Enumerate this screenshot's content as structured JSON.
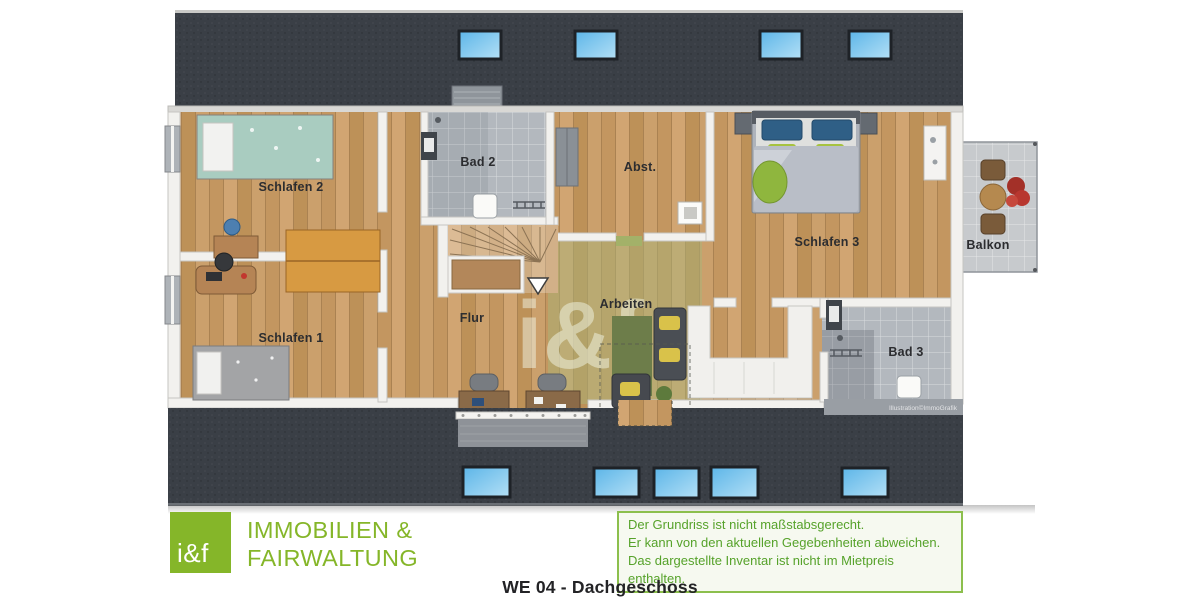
{
  "meta": {
    "title": "WE 04 - Dachgeschoss"
  },
  "branding": {
    "logo_text": "i&f",
    "company_line1": "IMMOBILIEN &",
    "company_line2": "FAIRWALTUNG",
    "brand_green": "#85b629"
  },
  "disclaimer": {
    "line1": "Der Grundriss ist nicht maßstabsgerecht.",
    "line2": "Er kann von den aktuellen Gegebenheiten abweichen.",
    "line3": "Das dargestellte Inventar ist nicht im Mietpreis enthalten."
  },
  "floorplan": {
    "watermark": "i&f",
    "credit": "Illustration©ImmoGrafik",
    "rooms": [
      {
        "id": "schlafen2",
        "label": "Schlafen 2"
      },
      {
        "id": "bad2",
        "label": "Bad 2"
      },
      {
        "id": "abst",
        "label": "Abst."
      },
      {
        "id": "schlafen3",
        "label": "Schlafen 3"
      },
      {
        "id": "balkon",
        "label": "Balkon"
      },
      {
        "id": "schlafen1",
        "label": "Schlafen 1"
      },
      {
        "id": "flur",
        "label": "Flur"
      },
      {
        "id": "arbeiten",
        "label": "Arbeiten"
      },
      {
        "id": "bad3",
        "label": "Bad 3"
      }
    ],
    "colors": {
      "roof": "#3a3f46",
      "wood_floor": "#c89c66",
      "bath_tile": "#b3b8be",
      "balcony_tile": "#c7cacd",
      "skylight_blue": "#7ec8ef",
      "wall": "#f2f1ee",
      "accent_rug_green": "#a9b478",
      "disclaimer_green": "#56a22a"
    }
  }
}
